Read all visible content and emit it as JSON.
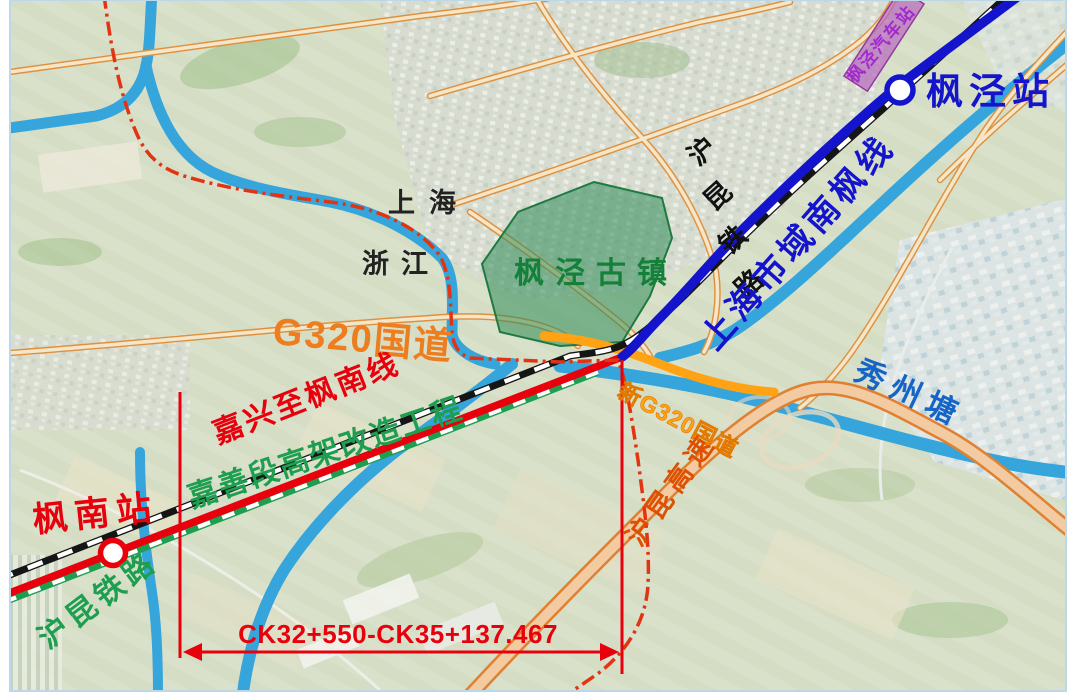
{
  "map": {
    "stations": {
      "fengjing": "枫泾站",
      "fengnan": "枫南站",
      "fengjing_bus": "枫泾汽车站"
    },
    "railway_chars": [
      "沪",
      "昆",
      "铁",
      "路"
    ],
    "labels": {
      "nanfeng_line": "上海市域南枫线",
      "ancient_town": "枫泾古镇",
      "province_shanghai": "上海",
      "province_zhejiang": "浙江",
      "g320": "G320国道",
      "new_g320": "新G320国道",
      "hukun_expressway": "沪昆高速",
      "xiuzhou_river": "秀州塘",
      "jiaxing_fengnan_line": "嘉兴至枫南线",
      "project_label_left": "沪昆铁路",
      "project_label_right": "嘉善段高架改造工程",
      "chainage": "CK32+550-CK35+137.467"
    },
    "colors": {
      "metro_line_blue": "#1414CC",
      "new_line_red": "#E8000D",
      "project_green": "#1E9E50",
      "road_orange": "#ED7D1F",
      "new_g320_orange": "#FFA314",
      "expressway_label_orange": "#DE4F00",
      "river_cyan": "#35A5DC",
      "river_label_blue": "#1565C8",
      "boundary_red": "#E23312",
      "bus_station_purple": "#A22ACC",
      "ancient_town_green": "#15803A"
    }
  }
}
